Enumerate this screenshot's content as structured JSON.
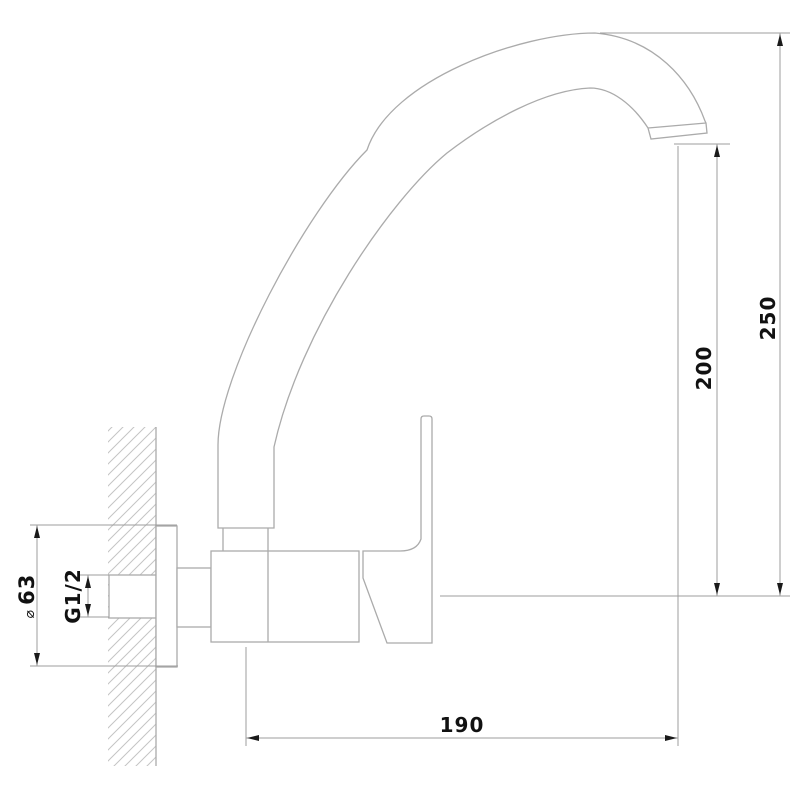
{
  "drawing": {
    "subject": "Wall-mounted single-lever kitchen mixer tap, side elevation, dimensioned technical line drawing",
    "view": "side section with hatched wall"
  },
  "dimensions": {
    "overall_height": {
      "label": "250"
    },
    "outlet_height": {
      "label": "200"
    },
    "spout_reach": {
      "label": "190"
    },
    "flange_diameter": {
      "symbol": "⌀",
      "label": "63"
    },
    "inlet_thread": {
      "label": "G1/2"
    }
  },
  "colors": {
    "outline": "#ababab",
    "hatch": "#c4c4c4",
    "dimension_line": "#9c9c9c",
    "arrow": "#1a1a1a",
    "label_text": "#111111",
    "background": "#ffffff"
  }
}
